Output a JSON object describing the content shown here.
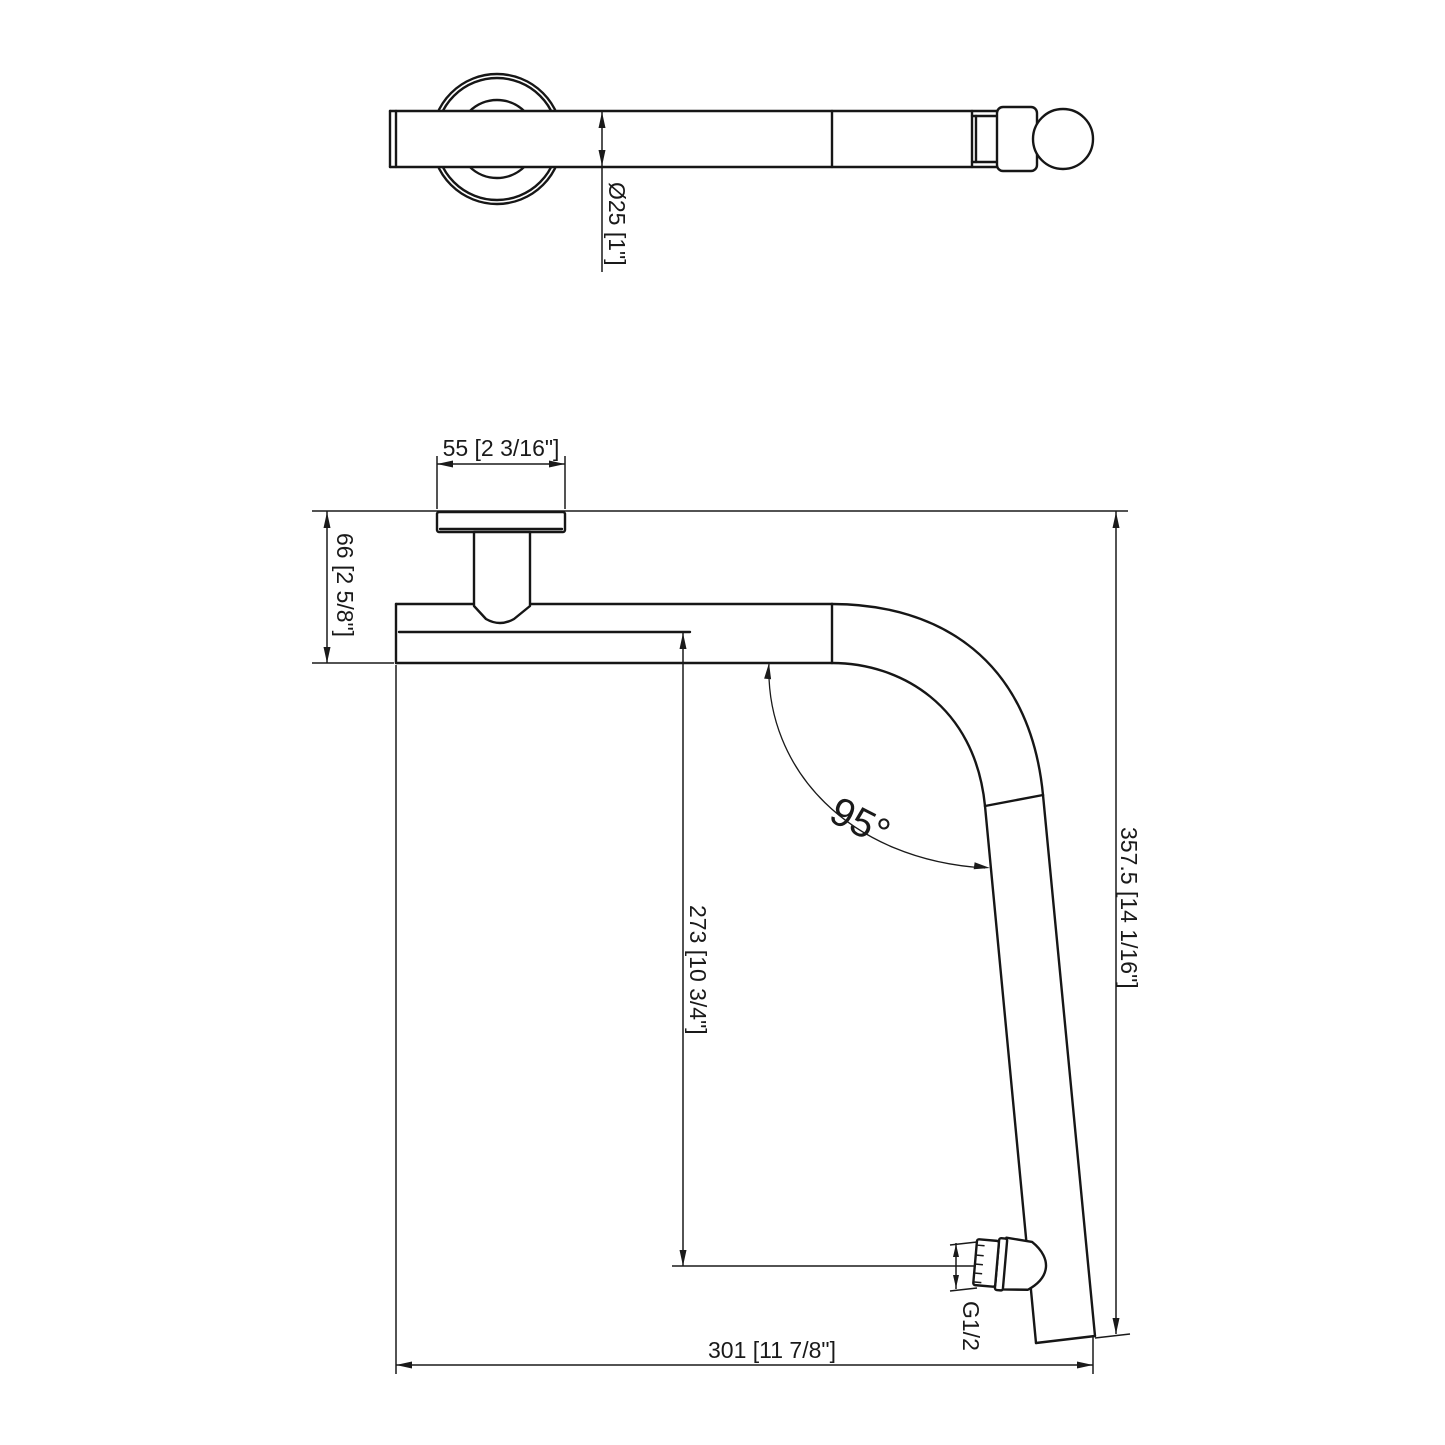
{
  "drawing": {
    "background": "#ffffff",
    "line_color": "#161616",
    "dimensions": {
      "arm_diameter": "Ø25 [1\"]",
      "flange_width": "55 [2 3/16\"]",
      "flange_drop": "66 [2 5/8\"]",
      "center_to_outlet": "273 [10 3/4\"]",
      "overall_height": "357.5 [14 1/16\"]",
      "overall_length": "301 [11 7/8\"]",
      "bend_angle": "95°",
      "outlet_thread": "G1/2"
    }
  }
}
